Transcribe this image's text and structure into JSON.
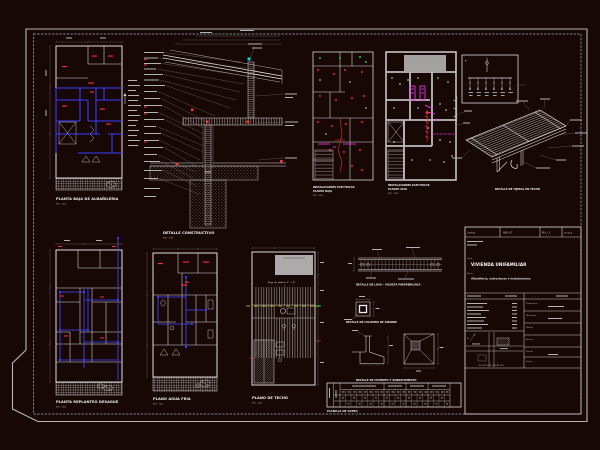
{
  "colors": {
    "background": "#170806",
    "line": "#dcdcdc",
    "dim_line": "#8f8f8f",
    "wall_blue": "#3c3cff",
    "accent_red": "#ff3232",
    "accent_magenta": "#ff3bff",
    "accent_green": "#2eff2e",
    "accent_cyan": "#00dede",
    "centerline_yellow": "#d6de3e",
    "border_gray": "#b6b6b6",
    "inner_border_blue": "#93a7bd"
  },
  "panels": {
    "planta_baja": {
      "caption": "PLANTA BAJA DE ALBAÑILERIA",
      "scale": "ESC. 1/50"
    },
    "detalle_constructivo": {
      "caption": "DETALLE CONSTRUCTIVO",
      "scale": "ESC. 1/10"
    },
    "electricas_pb": {
      "caption_line1": "INSTALACIONES ELECTRICAS",
      "caption_line2": "PLANTA BAJA",
      "scale": "ESC. 1/50"
    },
    "electricas_pa": {
      "caption_line1": "INSTALACIONES ELECTRICAS",
      "caption_line2": "PLANTA ALTA",
      "scale": "ESC. 1/50"
    },
    "unifilar": {
      "label": "M"
    },
    "tijeral": {
      "caption": "DETALLE DE TIJERAL EN TECHO"
    },
    "replanteo": {
      "caption": "PLANTA REPLANTEO DESAGUE",
      "scale": "ESC. 1/50"
    },
    "agua": {
      "caption": "PLANO AGUA FRIA",
      "scale": "ESC. 1/50"
    },
    "techo": {
      "caption": "PLANO DE TECHO",
      "scale": "ESC. 1/50",
      "note": "Viga de madera 2\" x 6\""
    },
    "vigueta": {
      "caption": "DETALLE DE LOSA - VIGUETA PREFABRICADA"
    },
    "columna": {
      "caption": "DETALLE DE COLUMNA DE AMARRE"
    },
    "zapata": {
      "caption": "DETALLE DE CIMIENTO Y SOBRECIMIENTO"
    },
    "planilla": {
      "caption": "PLANILLA DE ACERO"
    }
  },
  "titleblock": {
    "header": {
      "c1": "LAMINA",
      "c2": "ARQ.-07",
      "c3": "PLA.- 2",
      "c4": "ESCALA"
    },
    "obra_label": "Obra:",
    "obra": "VIVIENDA UNIFAMILIAR",
    "plano_label": "Plano:",
    "plano": "Albañileria, estructuras e instalaciones",
    "croquis_caption": "CROQUIS DE UBICACION",
    "north_label": "N",
    "fields": {
      "f1": "Propietario:",
      "f2": "Ubicacion:",
      "f3": "Dibujo:",
      "f4": "Reviso:",
      "f5": "Escala:",
      "f6": "Fecha:"
    }
  }
}
